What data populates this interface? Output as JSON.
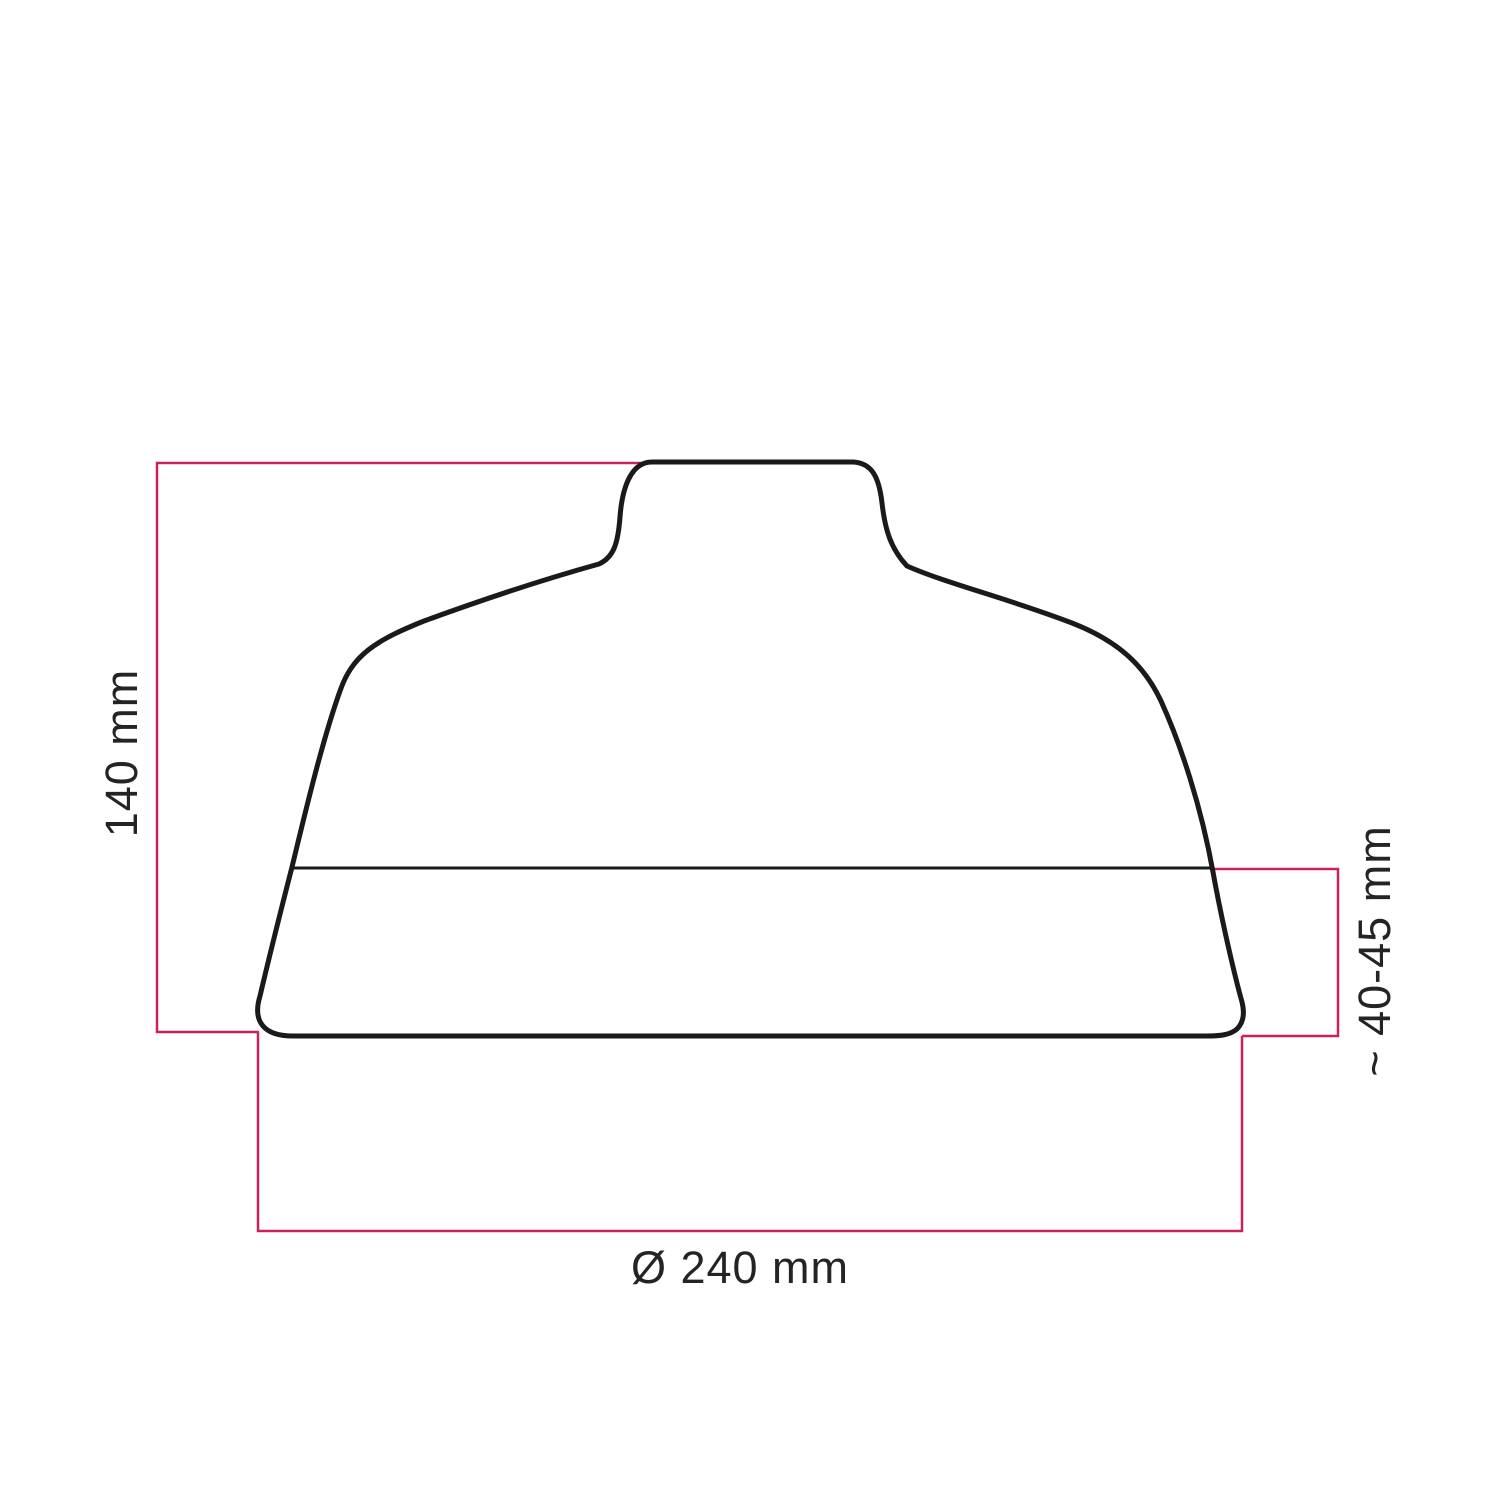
{
  "title": "Lampshade dimension drawing",
  "colors": {
    "background": "#ffffff",
    "outline": "#1a1a1a",
    "dimension_line": "#c9215e",
    "label_text": "#242424",
    "shape_fill": "#ffffff"
  },
  "diagram": {
    "kind": "technical-dimension-diagram",
    "subject": "lampshade side profile silhouette",
    "labels": {
      "height": "140 mm",
      "band_height": "~ 40-45 mm",
      "diameter": "Ø 240 mm"
    },
    "measurements": {
      "height_mm": 140,
      "diameter_mm": 240,
      "band_height_mm": "40-45"
    }
  }
}
